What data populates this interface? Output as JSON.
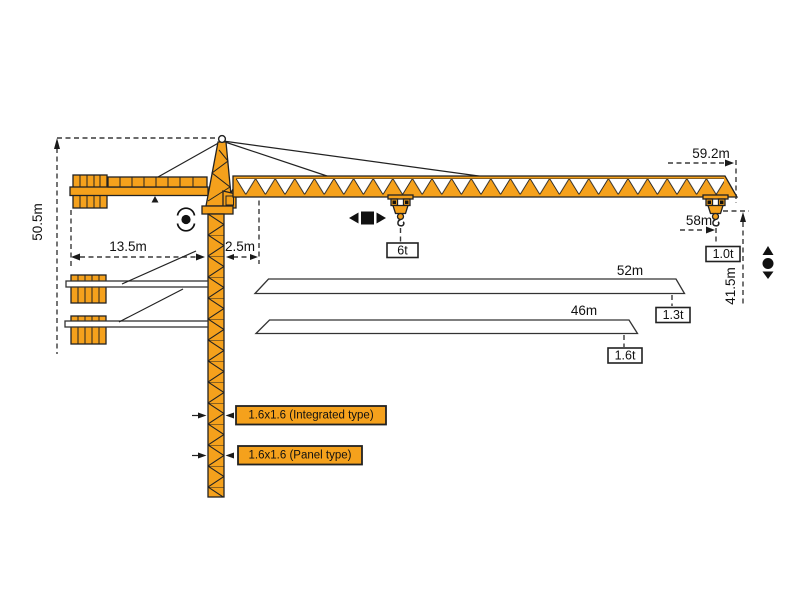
{
  "dimensions": {
    "total_height": "50.5m",
    "counter_jib_radius": "13.5m",
    "jib_root_offset": "2.5m",
    "max_jib_length": "59.2m",
    "max_working_radius": "58m",
    "lifting_height": "41.5m"
  },
  "loads": {
    "max_capacity": "6t",
    "tip_load_max_jib": "1.0t"
  },
  "jib_options": [
    {
      "length": "52m",
      "tip_load": "1.3t"
    },
    {
      "length": "46m",
      "tip_load": "1.6t"
    }
  ],
  "mast_sections": [
    {
      "label": "1.6x1.6 (Integrated type)"
    },
    {
      "label": "1.6x1.6 (Panel type)"
    }
  ],
  "icons": {
    "slewing": "slewing-rotation-icon",
    "trolley": "trolley-travel-icon",
    "hoist": "hoisting-icon"
  },
  "colors": {
    "crane_orange": "#f5a11c",
    "outline": "#222222",
    "dimension_line": "#3a3a3a"
  }
}
